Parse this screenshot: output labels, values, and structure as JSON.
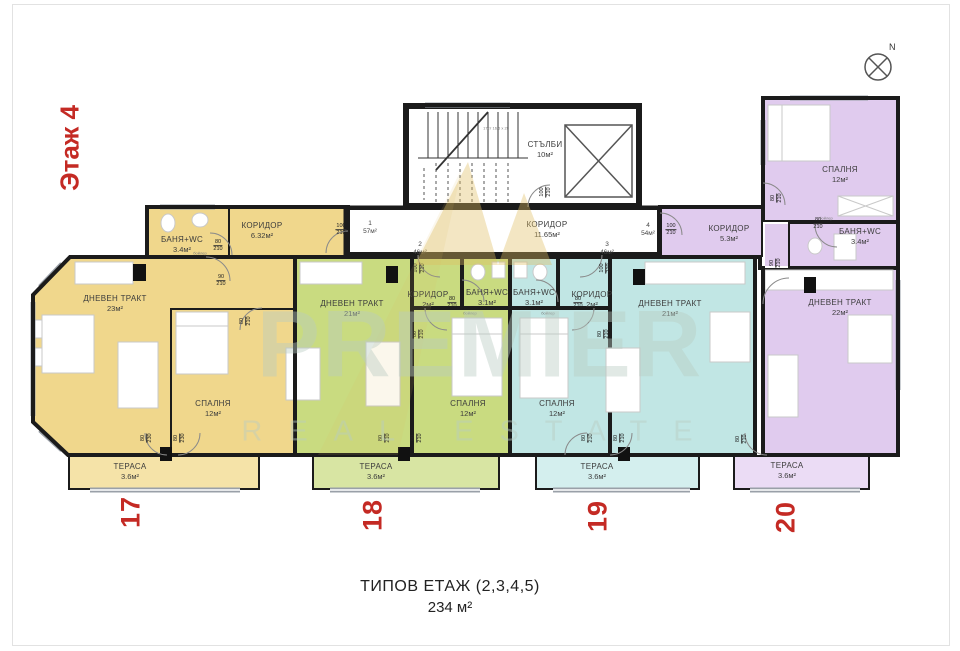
{
  "page": {
    "floor_label": "Этаж 4",
    "caption_line1": "ТИПОВ ЕТАЖ (2,3,4,5)",
    "caption_line2": "234 м²",
    "compass_n": "N"
  },
  "watermark": {
    "line1": "PREMIER",
    "line2": "REAL ESTATE"
  },
  "colors": {
    "apt17": "#f0d78c",
    "apt17_terrace": "#f5e3a8",
    "apt18": "#c9db80",
    "apt18_terrace": "#d8e5a3",
    "apt19": "#c1e6e4",
    "apt19_terrace": "#d4efee",
    "apt20": "#e0cbee",
    "apt20_terrace": "#ebdcf5",
    "red": "#c42a24"
  },
  "common_areas": {
    "stairs_name": "СТЪЛБИ",
    "stairs_area": "10м²",
    "stairs_note": "17ст 16.5 x 28",
    "corridor_name": "КОРИДОР",
    "corridor_area": "11.65м²"
  },
  "units": [
    {
      "number": "1",
      "area": "57м²"
    },
    {
      "number": "2",
      "area": "46м²"
    },
    {
      "number": "3",
      "area": "46м²"
    },
    {
      "number": "4",
      "area": "54м²"
    }
  ],
  "door_sizes": {
    "d80_210": {
      "w": "80",
      "h": "210"
    },
    "d90_210": {
      "w": "90",
      "h": "210"
    },
    "d100_210": {
      "w": "100",
      "h": "210"
    },
    "d80_230": {
      "w": "80",
      "h": "230"
    }
  },
  "fixture_note": "бойлер",
  "apartments": [
    {
      "plan_no": "17",
      "rooms": {
        "living": {
          "name": "ДНЕВЕН ТРАКТ",
          "area": "23м²"
        },
        "bedroom": {
          "name": "СПАЛНЯ",
          "area": "12м²"
        },
        "corridor": {
          "name": "КОРИДОР",
          "area": "6.32м²"
        },
        "bath": {
          "name": "БАНЯ+WC",
          "area": "3.4м²"
        },
        "terrace": {
          "name": "ТЕРАСА",
          "area": "3.6м²"
        }
      }
    },
    {
      "plan_no": "18",
      "rooms": {
        "living": {
          "name": "ДНЕВЕН ТРАКТ",
          "area": "21м²"
        },
        "bedroom": {
          "name": "СПАЛНЯ",
          "area": "12м²"
        },
        "corridor": {
          "name": "КОРИДОР",
          "area": "2м²"
        },
        "bath": {
          "name": "БАНЯ+WC",
          "area": "3.1м²"
        },
        "terrace": {
          "name": "ТЕРАСА",
          "area": "3.6м²"
        }
      }
    },
    {
      "plan_no": "19",
      "rooms": {
        "living": {
          "name": "ДНЕВЕН ТРАКТ",
          "area": "21м²"
        },
        "bedroom": {
          "name": "СПАЛНЯ",
          "area": "12м²"
        },
        "corridor": {
          "name": "КОРИДОР",
          "area": "2м²"
        },
        "bath": {
          "name": "БАНЯ+WC",
          "area": "3.1м²"
        },
        "terrace": {
          "name": "ТЕРАСА",
          "area": "3.6м²"
        }
      }
    },
    {
      "plan_no": "20",
      "rooms": {
        "living": {
          "name": "ДНЕВЕН ТРАКТ",
          "area": "22м²"
        },
        "bedroom": {
          "name": "СПАЛНЯ",
          "area": "12м²"
        },
        "corridor": {
          "name": "КОРИДОР",
          "area": "5.3м²"
        },
        "bath": {
          "name": "БАНЯ+WC",
          "area": "3.4м²"
        },
        "terrace": {
          "name": "ТЕРАСА",
          "area": "3.6м²"
        }
      }
    }
  ]
}
